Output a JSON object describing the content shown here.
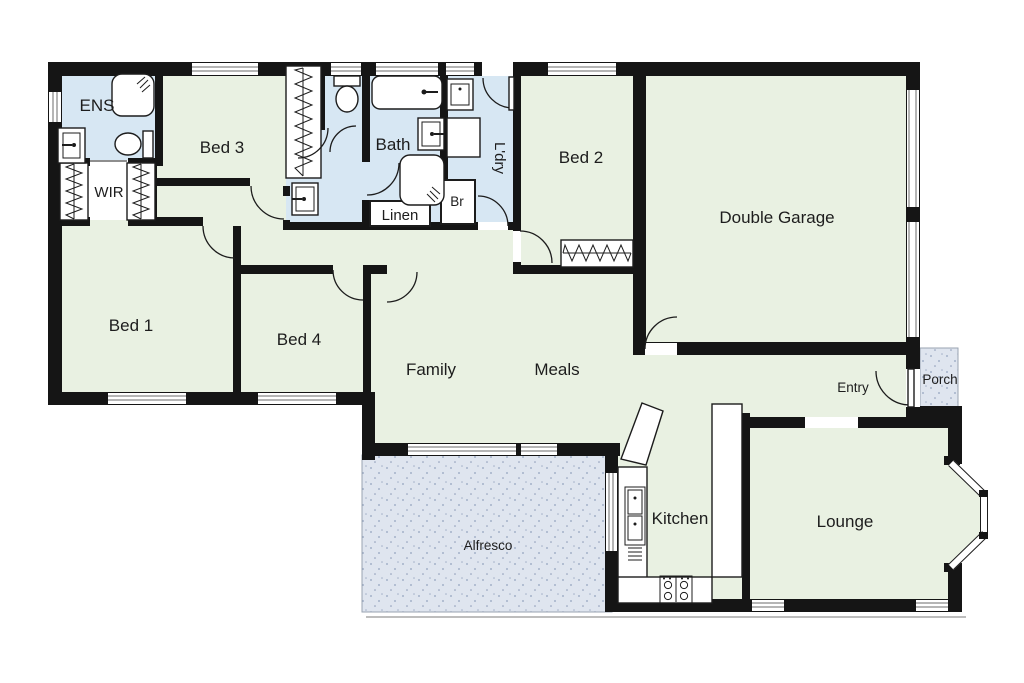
{
  "plan": {
    "colors": {
      "room": "#e9f1e2",
      "wet": "#d7e7f3",
      "outdoor": "#dfe5ef",
      "outdoor_dot": "#93a2bd",
      "wall": "#151515"
    },
    "rooms": {
      "ens": {
        "label": "ENS"
      },
      "wir": {
        "label": "WIR"
      },
      "bed3": {
        "label": "Bed 3"
      },
      "bath": {
        "label": "Bath"
      },
      "laundry": {
        "label": "L'dry"
      },
      "broom": {
        "label": "Br"
      },
      "linen": {
        "label": "Linen"
      },
      "bed2": {
        "label": "Bed 2"
      },
      "garage": {
        "label": "Double Garage"
      },
      "bed1": {
        "label": "Bed 1"
      },
      "bed4": {
        "label": "Bed 4"
      },
      "family": {
        "label": "Family"
      },
      "meals": {
        "label": "Meals"
      },
      "entry": {
        "label": "Entry"
      },
      "porch": {
        "label": "Porch"
      },
      "kitchen": {
        "label": "Kitchen"
      },
      "lounge": {
        "label": "Lounge"
      },
      "alfresco": {
        "label": "Alfresco"
      }
    }
  }
}
